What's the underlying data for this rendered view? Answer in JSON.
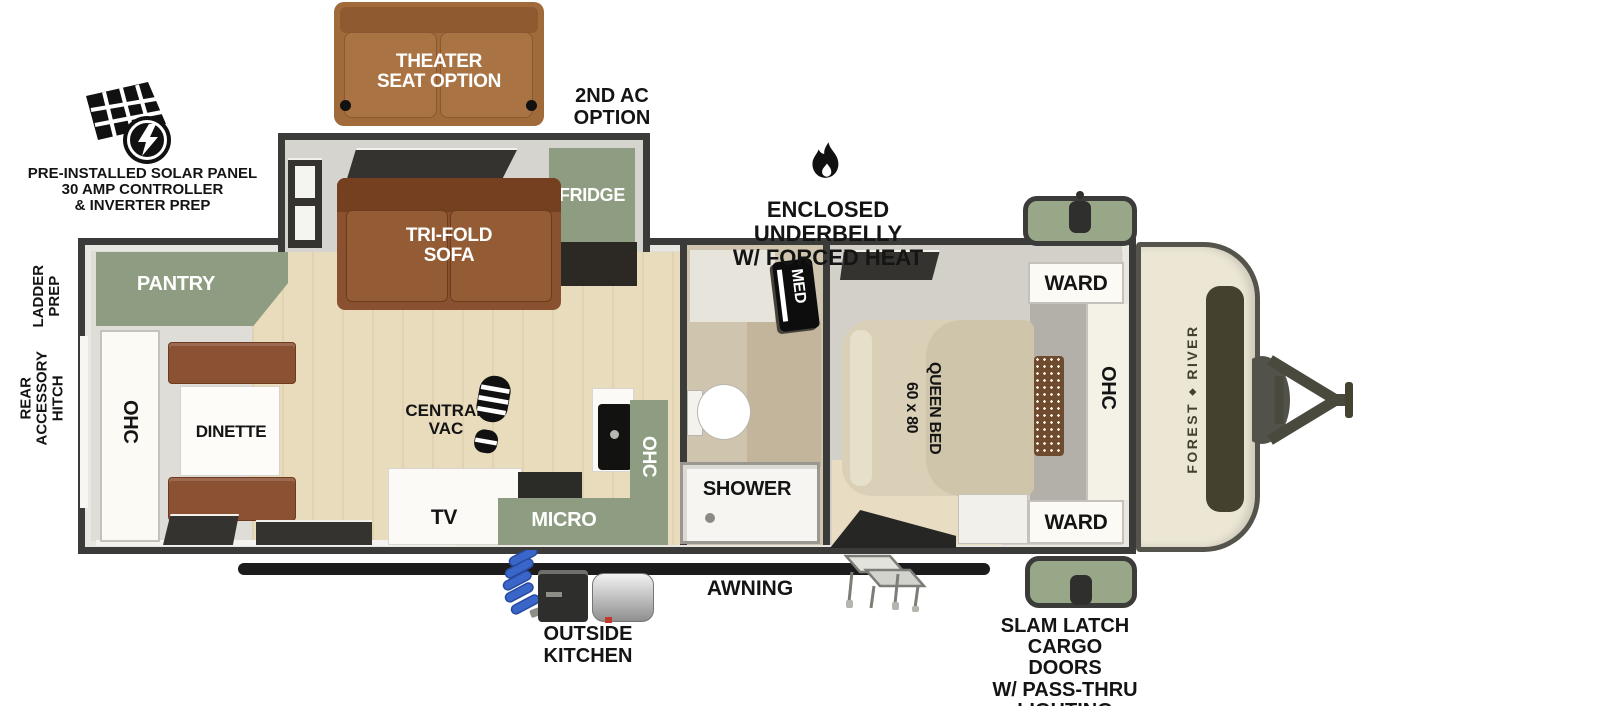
{
  "annotations": {
    "solar": {
      "lines": [
        "PRE-INSTALLED SOLAR PANEL",
        "30 AMP CONTROLLER",
        "& INVERTER PREP"
      ]
    },
    "theater": {
      "lines": [
        "THEATER",
        "SEAT OPTION"
      ]
    },
    "second_ac": {
      "lines": [
        "2ND AC",
        "OPTION"
      ]
    },
    "underbelly": {
      "lines": [
        "ENCLOSED UNDERBELLY",
        "W/ FORCED HEAT"
      ]
    },
    "ladder": {
      "lines": [
        "LADDER",
        "PREP"
      ]
    },
    "rear_hitch": {
      "lines": [
        "REAR",
        "ACCESSORY",
        "HITCH"
      ]
    },
    "awning": {
      "label": "AWNING"
    },
    "outside_kitchen": {
      "lines": [
        "OUTSIDE",
        "KITCHEN"
      ]
    },
    "cargo": {
      "lines": [
        "SLAM LATCH",
        "CARGO DOORS",
        "W/ PASS-THRU",
        "LIGHTING"
      ]
    },
    "brand": {
      "word1": "FOREST",
      "word2": "RIVER",
      "emblem": "◆"
    }
  },
  "interior": {
    "pantry": "PANTRY",
    "ohc_rear": "OHC",
    "dinette": "DINETTE",
    "sofa": {
      "lines": [
        "TRI-FOLD",
        "SOFA"
      ]
    },
    "fridge": "FRIDGE",
    "central_vac": {
      "lines": [
        "CENTRAL",
        "VAC"
      ]
    },
    "tv": "TV",
    "micro": "MICRO",
    "ohc_kitchen": "OHC",
    "med": "MED",
    "shower": "SHOWER",
    "ward_top": "WARD",
    "ward_bottom": "WARD",
    "ohc_bedroom": "OHC",
    "bed": {
      "lines": [
        "60 x 80",
        "QUEEN BED"
      ]
    }
  },
  "colors": {
    "wall": "#3b3b39",
    "cabinet_green": "#8e9d81",
    "sofa_brown": "#8a5130",
    "theater_brown": "#a06a3b",
    "wood_floor": "#e9dcbd",
    "bath_floor": "#cfc5af",
    "bed_tan": "#d9d0b7",
    "cap_cream": "#ece7d5",
    "hose_blue": "#3a66c9"
  }
}
